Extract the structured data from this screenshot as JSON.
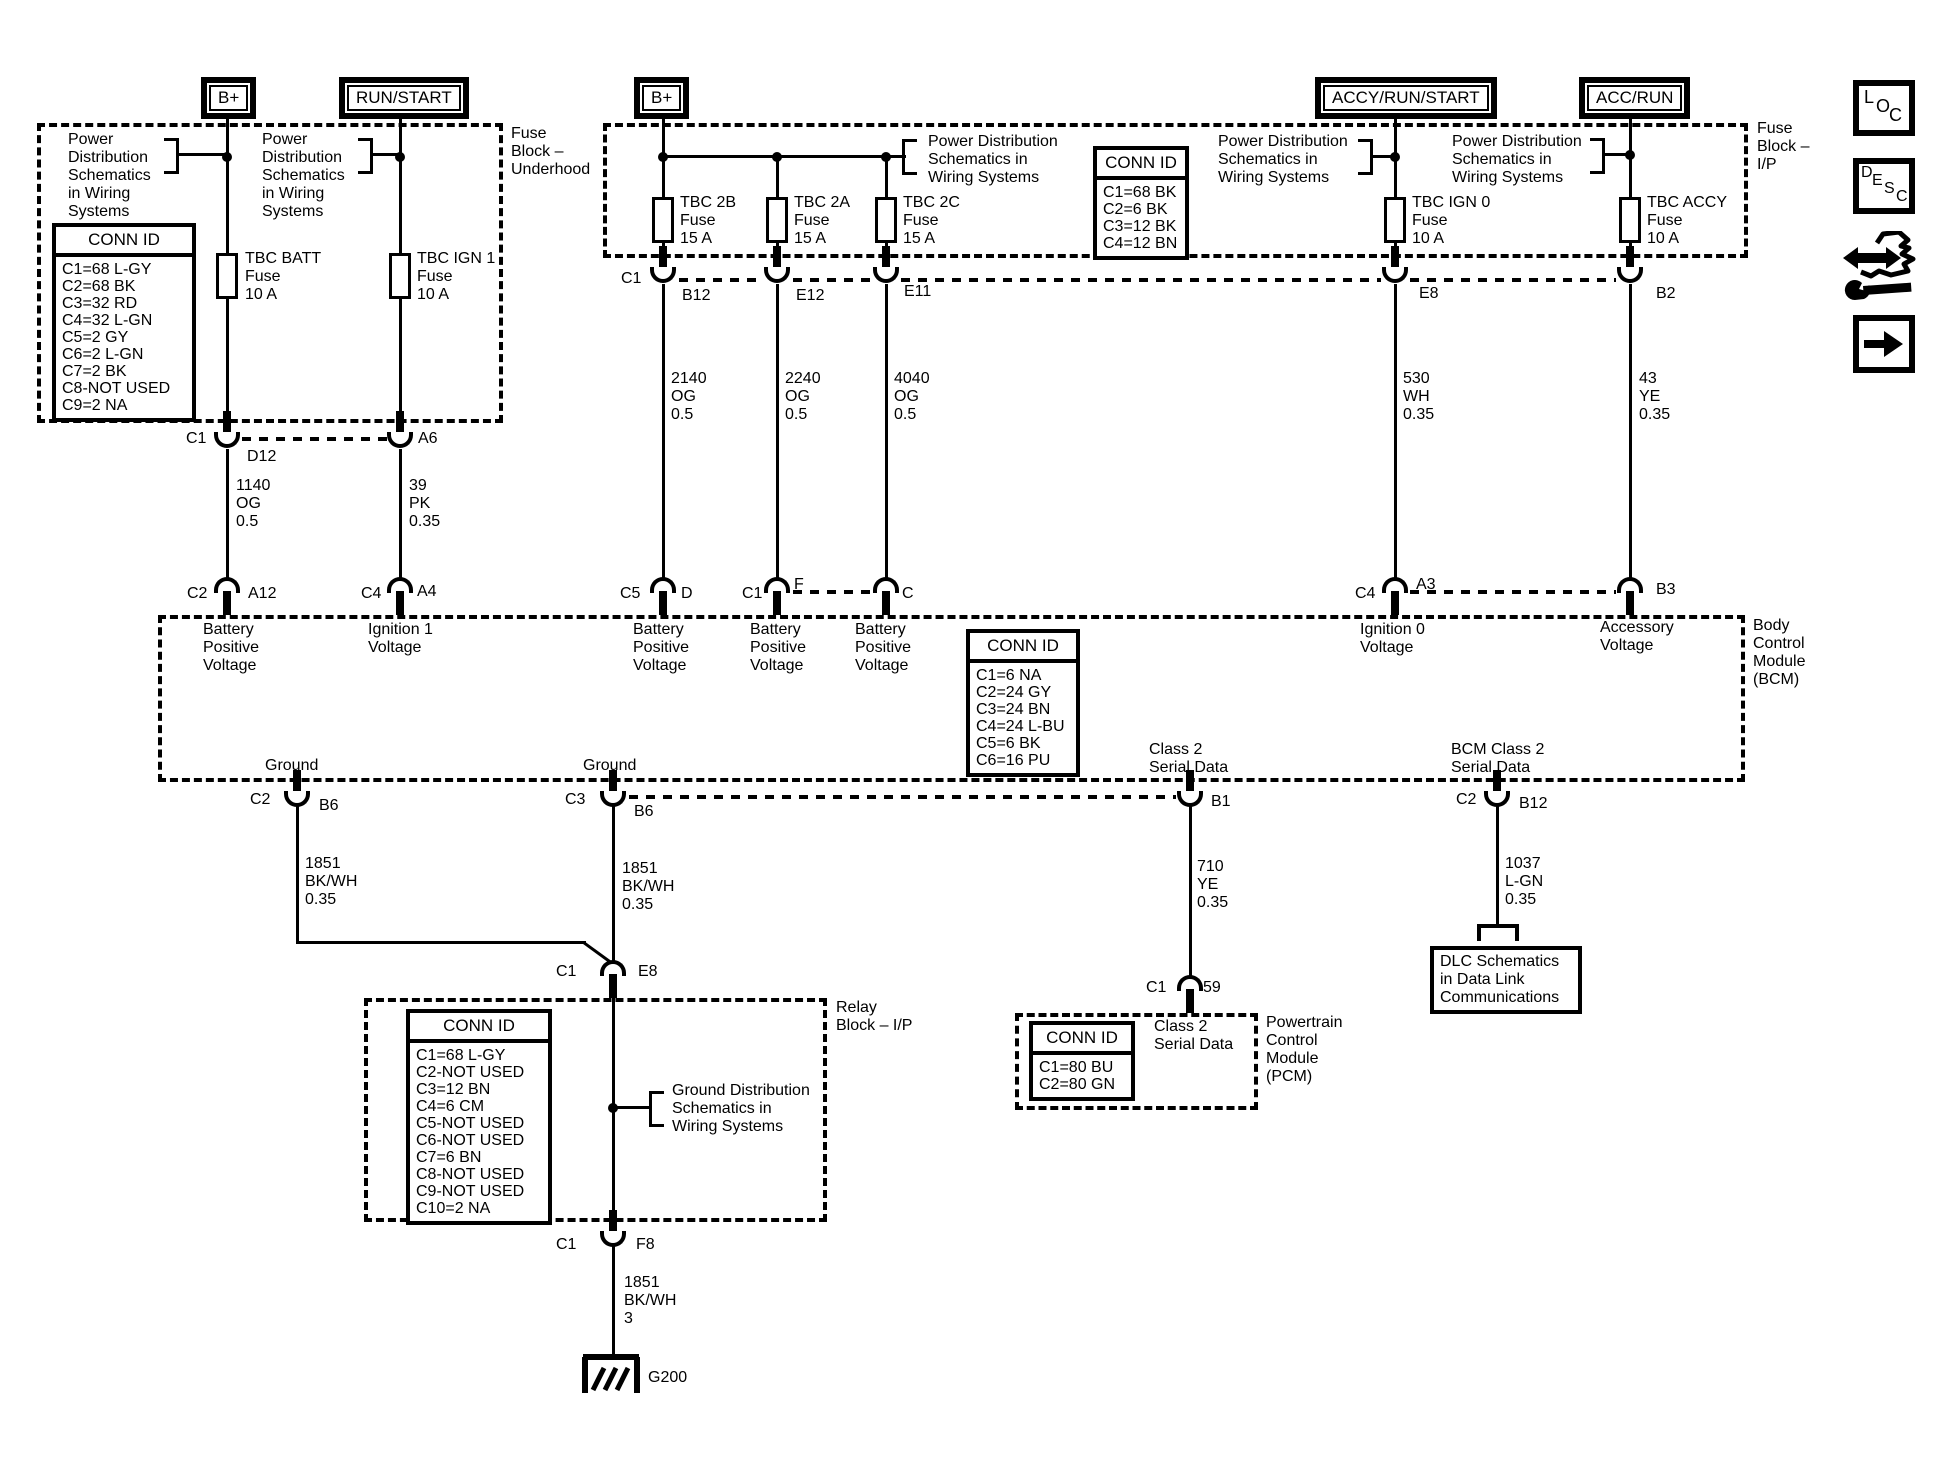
{
  "terminals": {
    "b_plus": "B+",
    "run_start": "RUN/START",
    "accy_run_start": "ACCY/RUN/START",
    "acc_run": "ACC/RUN"
  },
  "blocks": {
    "underhood": "Fuse\nBlock –\nUnderhood",
    "ip": "Fuse\nBlock –\nI/P",
    "bcm": "Body\nControl\nModule\n(BCM)",
    "pcm": "Powertrain\nControl\nModule\n(PCM)",
    "relay": "Relay\nBlock – I/P"
  },
  "notes": {
    "power5": "Power\nDistribution\nSchematics\nin Wiring\nSystems",
    "power3": "Power Distribution\nSchematics in\nWiring Systems",
    "ground": "Ground Distribution\nSchematics in\nWiring Systems",
    "dlc": "DLC Schematics\nin Data Link\nCommunications"
  },
  "conn_ids": {
    "underhood": {
      "title": "CONN ID",
      "rows": [
        "C1=68 L-GY",
        "C2=68 BK",
        "C3=32 RD",
        "C4=32 L-GN",
        "C5=2 GY",
        "C6=2 L-GN",
        "C7=2 BK",
        "C8-NOT USED",
        "C9=2 NA"
      ]
    },
    "ip": {
      "title": "CONN ID",
      "rows": [
        "C1=68 BK",
        "C2=6 BK",
        "C3=12 BK",
        "C4=12 BN"
      ]
    },
    "bcm": {
      "title": "CONN ID",
      "rows": [
        "C1=6 NA",
        "C2=24 GY",
        "C3=24 BN",
        "C4=24 L-BU",
        "C5=6 BK",
        "C6=16 PU"
      ]
    },
    "pcm": {
      "title": "CONN ID",
      "rows": [
        "C1=80 BU",
        "C2=80 GN"
      ]
    },
    "relay": {
      "title": "CONN ID",
      "rows": [
        "C1=68 L-GY",
        "C2-NOT USED",
        "C3=12 BN",
        "C4=6 CM",
        "C5-NOT USED",
        "C6-NOT USED",
        "C7=6 BN",
        "C8-NOT USED",
        "C9-NOT USED",
        "C10=2 NA"
      ]
    }
  },
  "fuses": {
    "tbc_batt": "TBC BATT\nFuse\n10 A",
    "tbc_ign1": "TBC IGN 1\nFuse\n10 A",
    "tbc_2b": "TBC 2B\nFuse\n15 A",
    "tbc_2a": "TBC 2A\nFuse\n15 A",
    "tbc_2c": "TBC 2C\nFuse\n15 A",
    "tbc_ign0": "TBC IGN 0\nFuse\n10 A",
    "tbc_accy": "TBC ACCY\nFuse\n10 A"
  },
  "wires": {
    "w1140": "1140\nOG\n0.5",
    "w39": "39\nPK\n0.35",
    "w2140": "2140\nOG\n0.5",
    "w2240": "2240\nOG\n0.5",
    "w4040": "4040\nOG\n0.5",
    "w530": "530\nWH\n0.35",
    "w43": "43\nYE\n0.35",
    "w1851_035": "1851\nBK/WH\n0.35",
    "w710": "710\nYE\n0.35",
    "w1037": "1037\nL-GN\n0.35",
    "w1851_3": "1851\nBK/WH\n3"
  },
  "pins": {
    "c1": "C1",
    "c2": "C2",
    "c3": "C3",
    "c4": "C4",
    "c5": "C5",
    "d12": "D12",
    "a6": "A6",
    "a12": "A12",
    "a4": "A4",
    "b12": "B12",
    "e12": "E12",
    "e11": "E11",
    "e8": "E8",
    "b2": "B2",
    "d": "D",
    "f": "F",
    "c": "C",
    "a3": "A3",
    "b3": "B3",
    "b6": "B6",
    "b1": "B1",
    "n59": "59",
    "f8": "F8",
    "g200": "G200"
  },
  "bcm_labels": {
    "batt": "Battery\nPositive\nVoltage",
    "ign1": "Ignition 1\nVoltage",
    "ign0": "Ignition 0\nVoltage",
    "acc": "Accessory\nVoltage",
    "ground": "Ground",
    "class2": "Class 2\nSerial Data",
    "bcm_class2": "BCM Class 2\nSerial Data"
  },
  "icons": {
    "loc": [
      "L",
      "O",
      "C"
    ],
    "desc": [
      "D",
      "E",
      "S",
      "C"
    ]
  }
}
